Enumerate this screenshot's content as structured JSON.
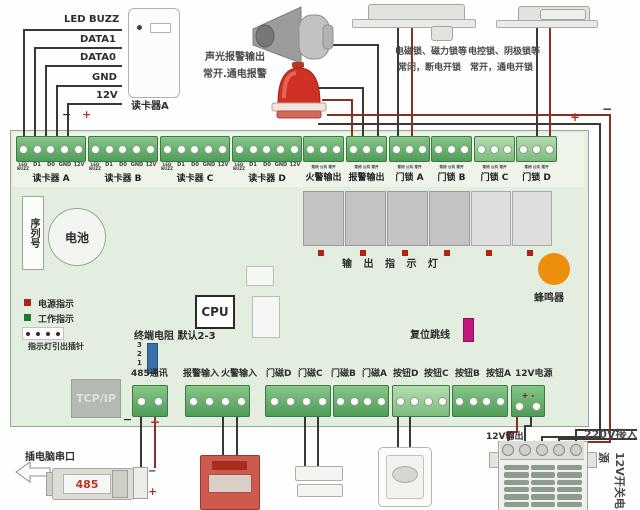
{
  "colors": {
    "board": "#e3eee0",
    "terminal_green": "#5fae68",
    "terminal_green_light": "#98cf97",
    "wire_black": "#3b3734",
    "wire_red": "#8b2f24",
    "accent_red": "#c03325",
    "buzzer_orange": "#ee8f0c"
  },
  "reader_wire_labels": [
    "LED BUZZ",
    "DATA1",
    "DATA0",
    "GND",
    "12V"
  ],
  "marks": {
    "minus": "−",
    "plus": "+"
  },
  "top_notes": {
    "alarm1": "声光报警输出",
    "alarm2": "常开.通电报警",
    "lock_left1": "电磁锁、磁力锁等",
    "lock_left2": "常闭，断电开锁",
    "lock_right1": "电控锁、阴极锁等",
    "lock_right2": "常开，通电开锁"
  },
  "devices": {
    "reader": "读卡器A",
    "serial_port_note": "插电脑串口",
    "converter": "485",
    "psu_out": "12V输出",
    "psu_in": "220V接入",
    "psu_name": "12V开关电源"
  },
  "top_blocks": {
    "readers": [
      {
        "pins": [
          "LED\nBUZZ",
          "D1",
          "D0",
          "GND",
          "12V"
        ],
        "label": "读卡器 A"
      },
      {
        "pins": [
          "LED\nBUZZ",
          "D1",
          "D0",
          "GND",
          "12V"
        ],
        "label": "读卡器 B"
      },
      {
        "pins": [
          "LED\nBUZZ",
          "D1",
          "D0",
          "GND",
          "12V"
        ],
        "label": "读卡器 C"
      },
      {
        "pins": [
          "LED\nBUZZ",
          "D1",
          "D0",
          "GND",
          "12V"
        ],
        "label": "读卡器 D"
      }
    ],
    "outputs": [
      {
        "pin_row": "常闭 公共 常开",
        "label": "火警输出"
      },
      {
        "pin_row": "常闭 公共 常开",
        "label": "报警输出"
      },
      {
        "pin_row": "常闭 公共 常开",
        "label": "门锁 A"
      },
      {
        "pin_row": "常闭 公共 常开",
        "label": "门锁 B"
      },
      {
        "pin_row": "常闭 公共 常开",
        "label": "门锁 C"
      },
      {
        "pin_row": "常闭 公共 常开",
        "label": "门锁 D"
      }
    ]
  },
  "board": {
    "serial": "序列号",
    "battery": "电池",
    "power_led": "电源指示",
    "work_led": "工作指示",
    "led_header_note": "指示灯引出插针",
    "cpu": "CPU",
    "term_res": "终端电阻 默认2-3",
    "jumper_pins": [
      "3",
      "2",
      "1"
    ],
    "output_leds": "输 出 指 示 灯",
    "buzzer": "蜂鸣器",
    "reset": "复位跳线",
    "tcpip": "TCP/IP"
  },
  "bottom_labels": [
    "485通讯",
    "报警输入",
    "火警输入",
    "门磁D",
    "门磁C",
    "门磁B",
    "门磁A",
    "按钮D",
    "按钮C",
    "按钮B",
    "按钮A",
    "12V电源"
  ],
  "psu_polarity": "+ -"
}
